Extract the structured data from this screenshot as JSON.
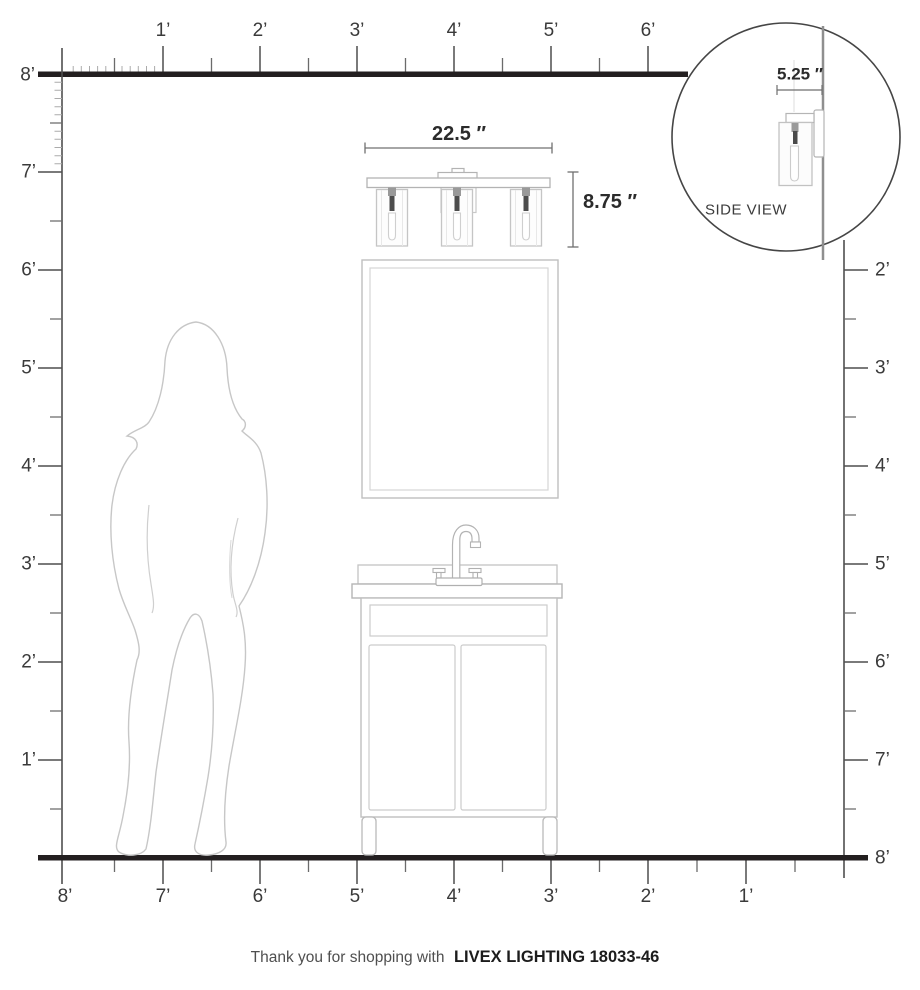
{
  "page": {
    "background": "#ffffff"
  },
  "colors": {
    "ruler_dark": "#231f20",
    "tick_gray": "#4f4f4f",
    "drawing_gray": "#c5c5c5",
    "dimension_text": "#2b2b2b"
  },
  "rulers": {
    "top": {
      "origin_label": "8’",
      "labels": [
        "1’",
        "2’",
        "3’",
        "4’",
        "5’",
        "6’"
      ]
    },
    "left": {
      "labels": [
        "7’",
        "6’",
        "5’",
        "4’",
        "3’",
        "2’",
        "1’"
      ]
    },
    "right": {
      "labels": [
        "2’",
        "3’",
        "4’",
        "5’",
        "6’",
        "7’"
      ],
      "bottom_label": "8’"
    },
    "bottom": {
      "labels": [
        "8’",
        "7’",
        "6’",
        "5’",
        "4’",
        "3’",
        "2’",
        "1’"
      ]
    }
  },
  "dimensions": {
    "fixture_width": "22.5 ″",
    "fixture_height": "8.75 ″",
    "fixture_depth": "5.25 ″"
  },
  "inset": {
    "label": "SIDE VIEW"
  },
  "caption": {
    "prefix": "Thank you for shopping with",
    "brand": "LIVEX LIGHTING 18033-46"
  }
}
